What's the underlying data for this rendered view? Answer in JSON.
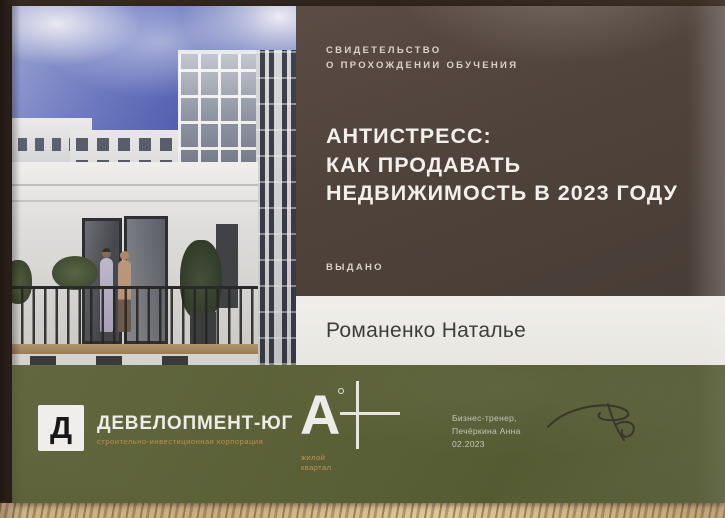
{
  "certificate": {
    "kicker_line1": "СВИДЕТЕЛЬСТВО",
    "kicker_line2": "О ПРОХОЖДЕНИИ ОБУЧЕНИЯ",
    "title_line1": "АНТИСТРЕСС:",
    "title_line2": "КАК ПРОДАВАТЬ",
    "title_line3": "НЕДВИЖИМОСТЬ В 2023 ГОДУ",
    "issued_label": "ВЫДАНО",
    "recipient_name": "Романенко Наталье"
  },
  "footer": {
    "developer_logo": {
      "glyph": "Д",
      "name": "ДЕВЕЛОПМЕНТ-ЮГ",
      "subtitle": "строительно-инвестиционная корпорация"
    },
    "aplus_logo": {
      "letter": "А",
      "caption_line1": "жилой",
      "caption_line2": "квартал"
    },
    "trainer": {
      "role": "Бизнес-тренер,",
      "name": "Печёркина Анна",
      "date": "02.2023"
    }
  },
  "colors": {
    "panel_brown": "#4d413b",
    "band_olive": "#596036",
    "accent_tan": "#c08f4f",
    "strip_white": "#f2f0ec",
    "wood_table": "#d3ba8c",
    "sky_blue": "#5b6cc0"
  }
}
